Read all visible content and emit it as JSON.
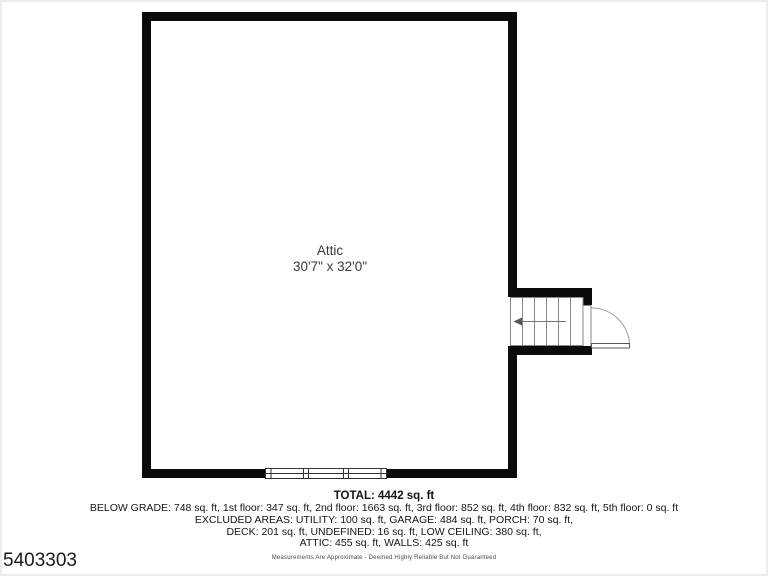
{
  "page": {
    "background": "#ffffff",
    "border_color": "#ececec"
  },
  "plan": {
    "room_label": "Attic",
    "room_dimensions": "30'7\" x 32'0\"",
    "wall_color": "#0b0b0b",
    "stair_line_color": "#888888",
    "door_arc_color": "#999999"
  },
  "summary": {
    "total": "TOTAL: 4442 sq. ft",
    "lines": [
      "BELOW GRADE: 748 sq. ft, 1st floor: 347 sq. ft, 2nd floor: 1663 sq. ft, 3rd floor: 852 sq. ft, 4th floor: 832 sq. ft, 5th floor: 0 sq. ft",
      "EXCLUDED AREAS: UTILITY: 100 sq. ft, GARAGE: 484 sq. ft, PORCH: 70 sq. ft,",
      "DECK: 201 sq. ft, UNDEFINED: 16 sq. ft, LOW CEILING: 380 sq. ft,",
      "ATTIC: 455 sq. ft, WALLS: 425 sq. ft"
    ]
  },
  "footer": {
    "disclaimer": "Measurements Are Approximate - Deemed Highly Reliable But Not Guaranteed",
    "plan_id": "5403303"
  }
}
